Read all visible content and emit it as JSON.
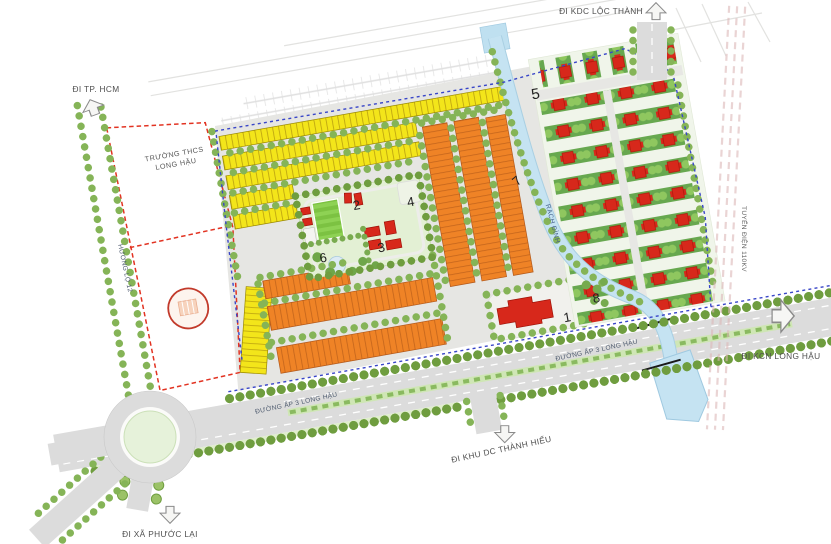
{
  "map": {
    "road_labels": {
      "kdc_loc_thanh": "ĐI KDC LỘC THÀNH",
      "tp_hcm": "ĐI TP. HCM",
      "xa_phuoc_lai": "ĐI XÃ PHƯỚC LẠI",
      "khu_dc_thanh_hieu": "ĐI KHU DC THÀNH HIẾU",
      "kcn_long_hau": "ĐI KCN LONG HẬU",
      "duong_ap3_west": "ĐƯỜNG ẤP 3 LONG HẬU",
      "duong_ap3_east": "ĐƯỜNG ẤP 3 LONG HẬU",
      "huong_lo_12": "HƯƠNG LỘ 12",
      "tuyen_dien_110kv": "TUYẾN ĐIỆN 110KV"
    },
    "water_labels": {
      "rach_dinh": "RẠCH ĐÌNH"
    },
    "site_labels": {
      "school_line1": "TRƯỜNG THCS",
      "school_line2": "LONG HẬU"
    },
    "markers": [
      "1",
      "2",
      "3",
      "4",
      "5",
      "6",
      "7",
      "8"
    ],
    "colors": {
      "shophouse_yellow": "#f3e51a",
      "shophouse_orange": "#ef8326",
      "villa_red": "#d7281b",
      "villa_green_row": "#67a84f",
      "park_green": "#e3f0d4",
      "tree_green": "#85b457",
      "water_blue": "#c5e3f2",
      "road_grey": "#dcdcdc",
      "boundary_blue": "#3946c8",
      "school_boundary_red": "#e23322",
      "school_fill_pink": "#fdf2ec"
    }
  }
}
